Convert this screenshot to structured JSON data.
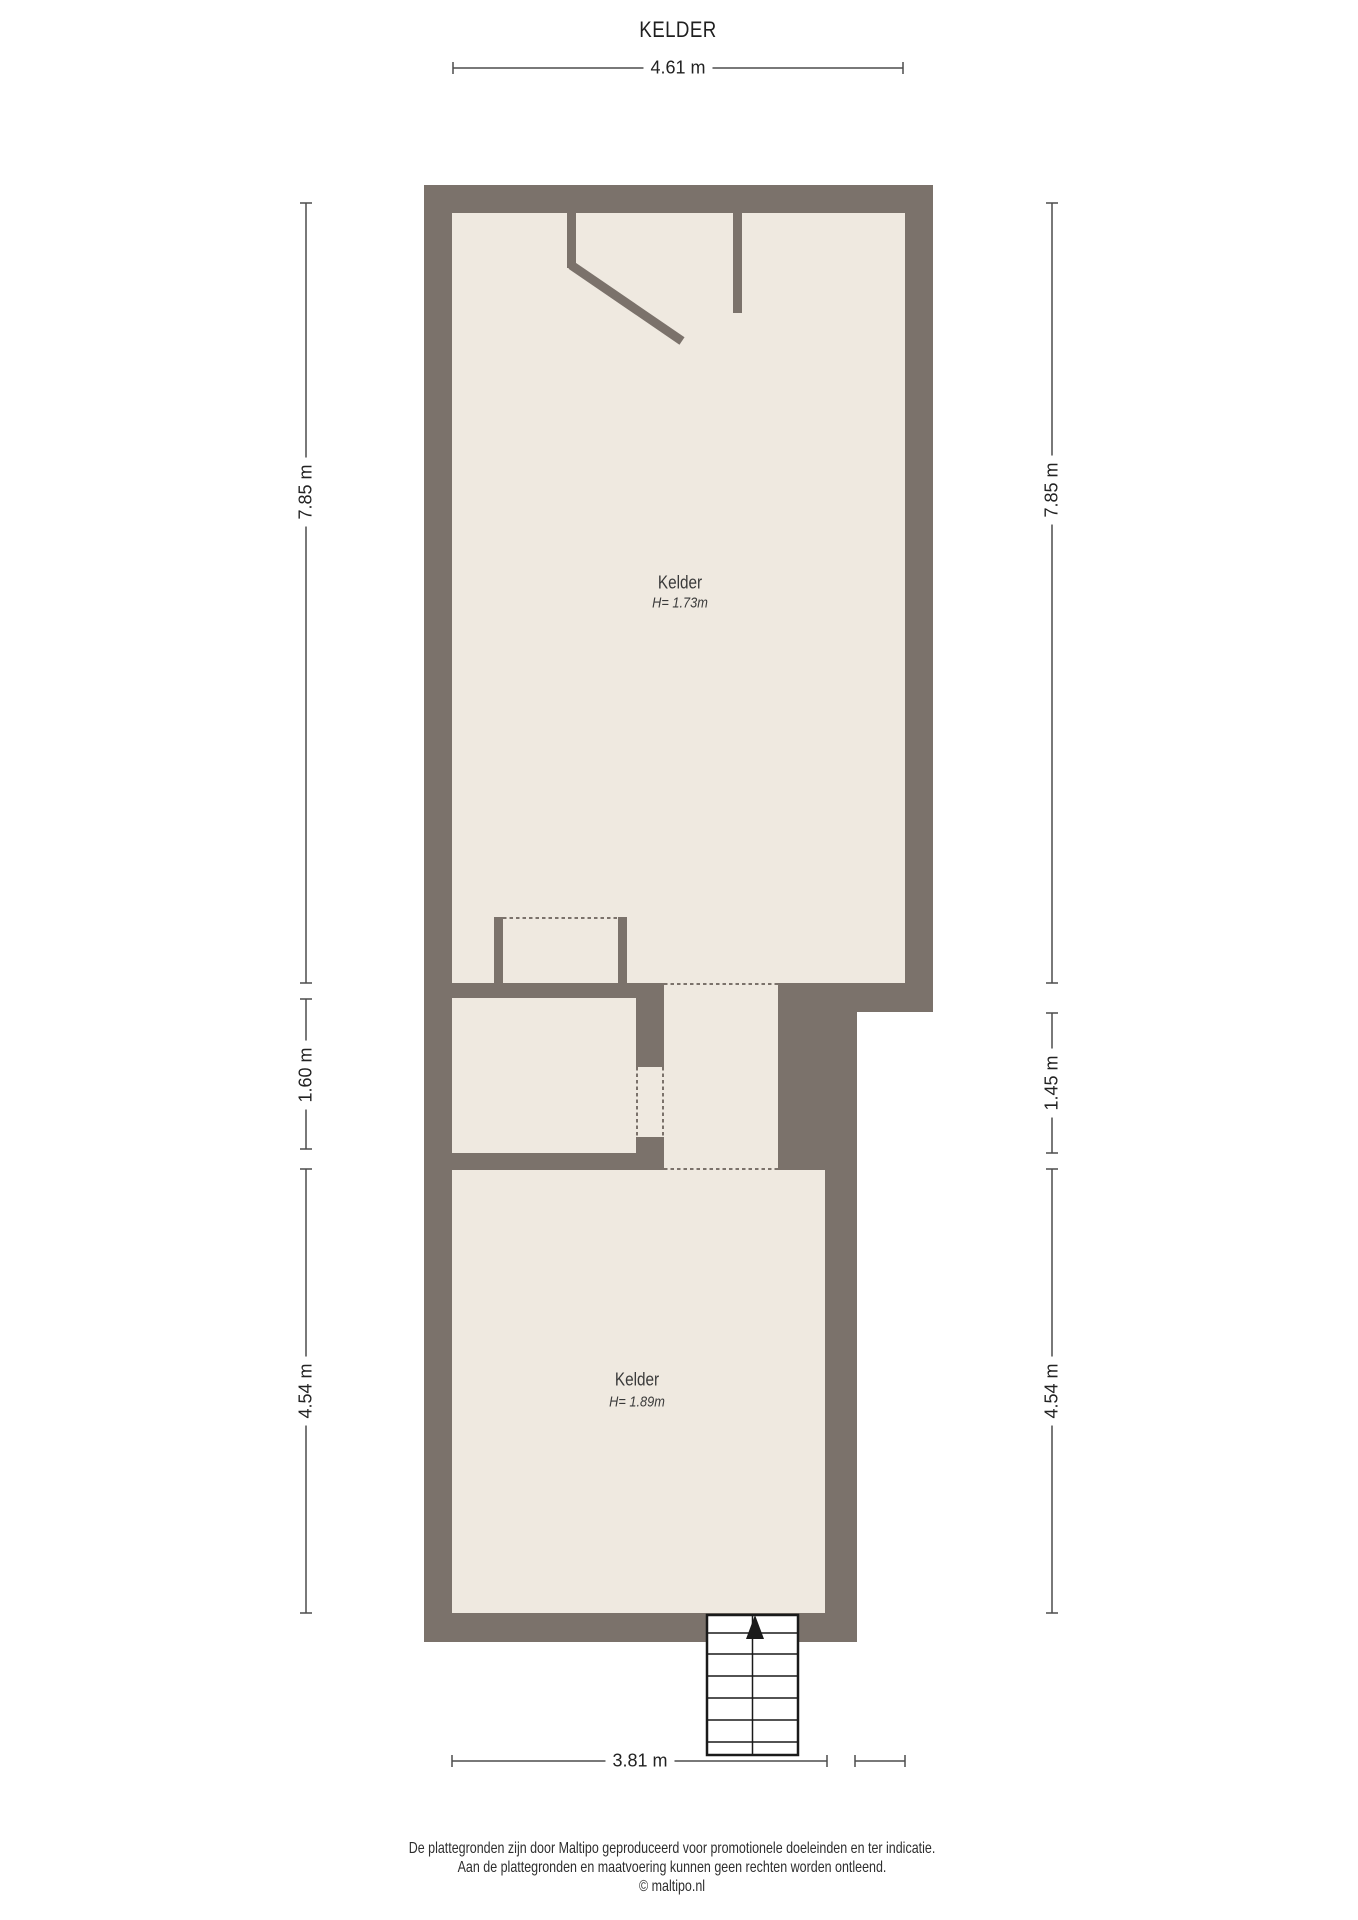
{
  "title": "KELDER",
  "plan": {
    "rooms": [
      {
        "name": "Kelder",
        "height": "H= 1.73m"
      },
      {
        "name": "Kelder",
        "height": "H= 1.89m"
      }
    ]
  },
  "dimensions": {
    "top": "4.61 m",
    "left_top": "7.85 m",
    "left_middle": "1.60 m",
    "left_bottom": "4.54 m",
    "right_top": "7.85 m",
    "right_middle": "1.45 m",
    "right_bottom": "4.54 m",
    "bottom": "3.81 m"
  },
  "footer": {
    "disclaimer_line1": "De plattegronden zijn door Maltipo geproduceerd voor promotionele doeleinden en ter indicatie.",
    "disclaimer_line2": "Aan de plattegronden en maatvoering kunnen geen rechten worden ontleend.",
    "copyright": "© maltipo.nl"
  },
  "colors": {
    "wall": "#7b726b",
    "floor": "#efe9e0",
    "dim": "#4d4d4d",
    "ink": "#1f1f1f",
    "label": "#3a3a3a",
    "stairs": "#1a1a1a",
    "paper": "#ffffff"
  }
}
